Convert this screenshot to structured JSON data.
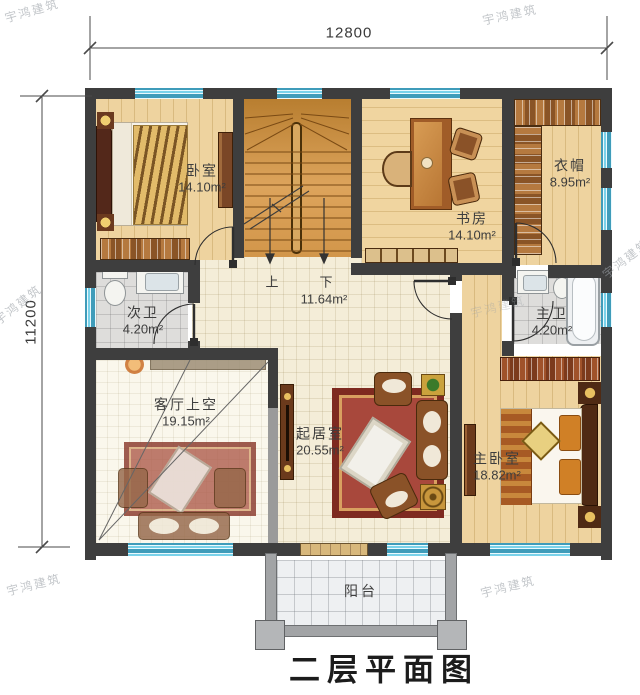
{
  "title": "二层平面图",
  "watermark": "宇鸿建筑",
  "dimensions": {
    "top": "12800",
    "left": "11200"
  },
  "rooms": {
    "bedroom": {
      "name": "卧室",
      "area": "14.10m²"
    },
    "study": {
      "name": "书房",
      "area": "14.10m²"
    },
    "cloakroom": {
      "name": "衣帽",
      "area": "8.95m²"
    },
    "bath_second": {
      "name": "次卫",
      "area": "4.20m²"
    },
    "bath_master": {
      "name": "主卫",
      "area": "4.20m²"
    },
    "hallway": {
      "area": "11.64m²",
      "up": "上",
      "down": "下"
    },
    "living_void": {
      "name": "客厅上空",
      "area": "19.15m²"
    },
    "living": {
      "name": "起居室",
      "area": "20.55m²"
    },
    "bedroom_master": {
      "name": "主卧室",
      "area": "18.82m²"
    },
    "balcony": {
      "name": "阳台"
    }
  },
  "colors": {
    "wall": "#3e3e3e",
    "window_glass": "#7ad2ea",
    "wood_floor": "#ecd2a0",
    "tile_floor": "#f4edd8",
    "bath_tile": "#dedddb",
    "stair_wood": "#d59a4a",
    "carpet_red": "#a8483c",
    "sofa_brown": "#8a5228",
    "balcony_wall": "#a2a4a6"
  }
}
